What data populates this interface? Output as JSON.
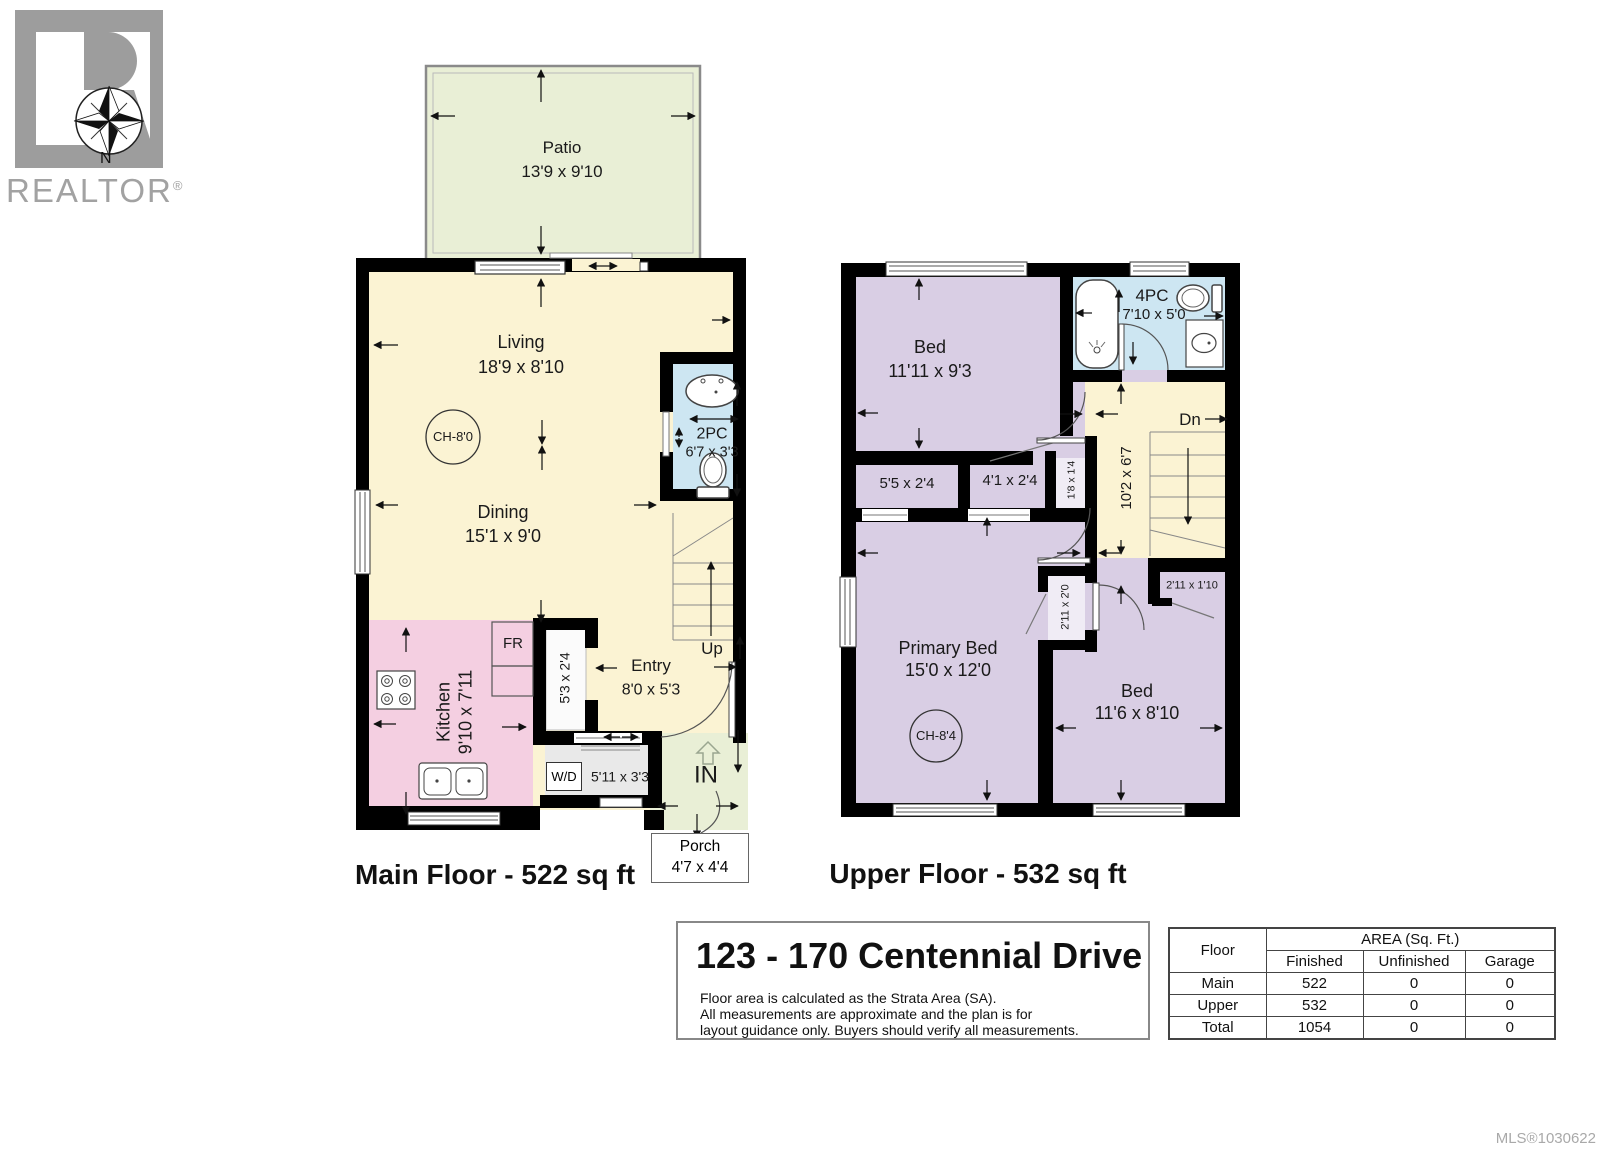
{
  "logo": {
    "realtor": "REALTOR",
    "reg": "®",
    "north": "N"
  },
  "main_floor": {
    "caption": "Main Floor - 522 sq ft",
    "patio": {
      "name": "Patio",
      "dims": "13'9 x 9'10"
    },
    "living": {
      "name": "Living",
      "dims": "18'9 x 8'10"
    },
    "dining": {
      "name": "Dining",
      "dims": "15'1 x 9'0"
    },
    "kitchen": {
      "name": "Kitchen",
      "dims": "9'10 x 7'11"
    },
    "bath": {
      "name": "2PC",
      "dims": "6'7 x 3'3"
    },
    "entry": {
      "name": "Entry",
      "dims": "8'0 x 5'3"
    },
    "porch": {
      "name": "Porch",
      "dims": "4'7 x 4'4"
    },
    "ceiling": "CH-8'0",
    "fridge": "FR",
    "closet": "5'3 x 2'4",
    "laundry": {
      "label": "W/D",
      "dims": "5'11 x 3'3"
    },
    "up": "Up",
    "in": "IN"
  },
  "upper_floor": {
    "caption": "Upper Floor - 532 sq ft",
    "bed1": {
      "name": "Bed",
      "dims": "11'11 x 9'3"
    },
    "bath": {
      "name": "4PC",
      "dims": "7'10 x 5'0"
    },
    "primary": {
      "name": "Primary Bed",
      "dims": "15'0 x 12'0"
    },
    "bed2": {
      "name": "Bed",
      "dims": "11'6 x 8'10"
    },
    "hall": "10'2 x 6'7",
    "dn": "Dn",
    "ceiling": "CH-8'4",
    "closets": {
      "c1": "5'5 x 2'4",
      "c2": "4'1 x 2'4",
      "c3": "1'8 x 1'4",
      "c4": "2'11 x 2'0",
      "c5": "2'11 x 1'10"
    }
  },
  "footer": {
    "address": "123 - 170 Centennial Drive",
    "disclaimer": [
      "Floor area is calculated as the Strata Area (SA).",
      "All measurements are approximate and the plan is for",
      "layout guidance only. Buyers should verify all measurements."
    ],
    "table": {
      "floor_header": "Floor",
      "area_header": "AREA (Sq. Ft.)",
      "columns": [
        "Finished",
        "Unfinished",
        "Garage"
      ],
      "rows": [
        {
          "floor": "Main",
          "finished": "522",
          "unfinished": "0",
          "garage": "0"
        },
        {
          "floor": "Upper",
          "finished": "532",
          "unfinished": "0",
          "garage": "0"
        },
        {
          "floor": "Total",
          "finished": "1054",
          "unfinished": "0",
          "garage": "0"
        }
      ]
    },
    "mls": "MLS®1030622"
  },
  "colors": {
    "floor_cream": "#fbf3d3",
    "outdoor_green": "#e9efd6",
    "kitchen_pink": "#f4cfe1",
    "bath_blue": "#cde6f2",
    "bedroom_lavender": "#d9cee4",
    "closet_white": "#f6f4f8",
    "wall_black": "#000000",
    "logo_gray": "#9d9d9d"
  }
}
